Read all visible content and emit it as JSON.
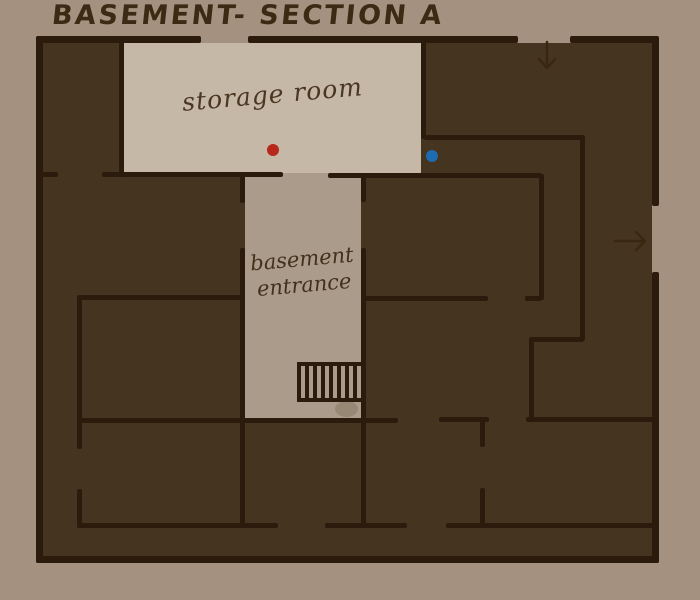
{
  "title": "BASEMENT- SECTION A",
  "rooms": {
    "storage": {
      "label": "storage room"
    },
    "basement_entrance": {
      "line1": "basement",
      "line2": "entrance"
    }
  },
  "markers": {
    "red_dot": {
      "color": "#b7281b"
    },
    "blue_dot": {
      "color": "#1e6bb0"
    }
  },
  "icons": {
    "top_door": "down-arrow-icon",
    "right_door": "right-arrow-icon",
    "stairs": "stairs-icon"
  },
  "palette": {
    "background": "#a5917f",
    "floor_dark": "#453420",
    "wall": "#2b1b0c",
    "storage_floor": "#c6b8a7",
    "entrance_floor": "#ab9b8a",
    "ink": "#3b2a14"
  }
}
